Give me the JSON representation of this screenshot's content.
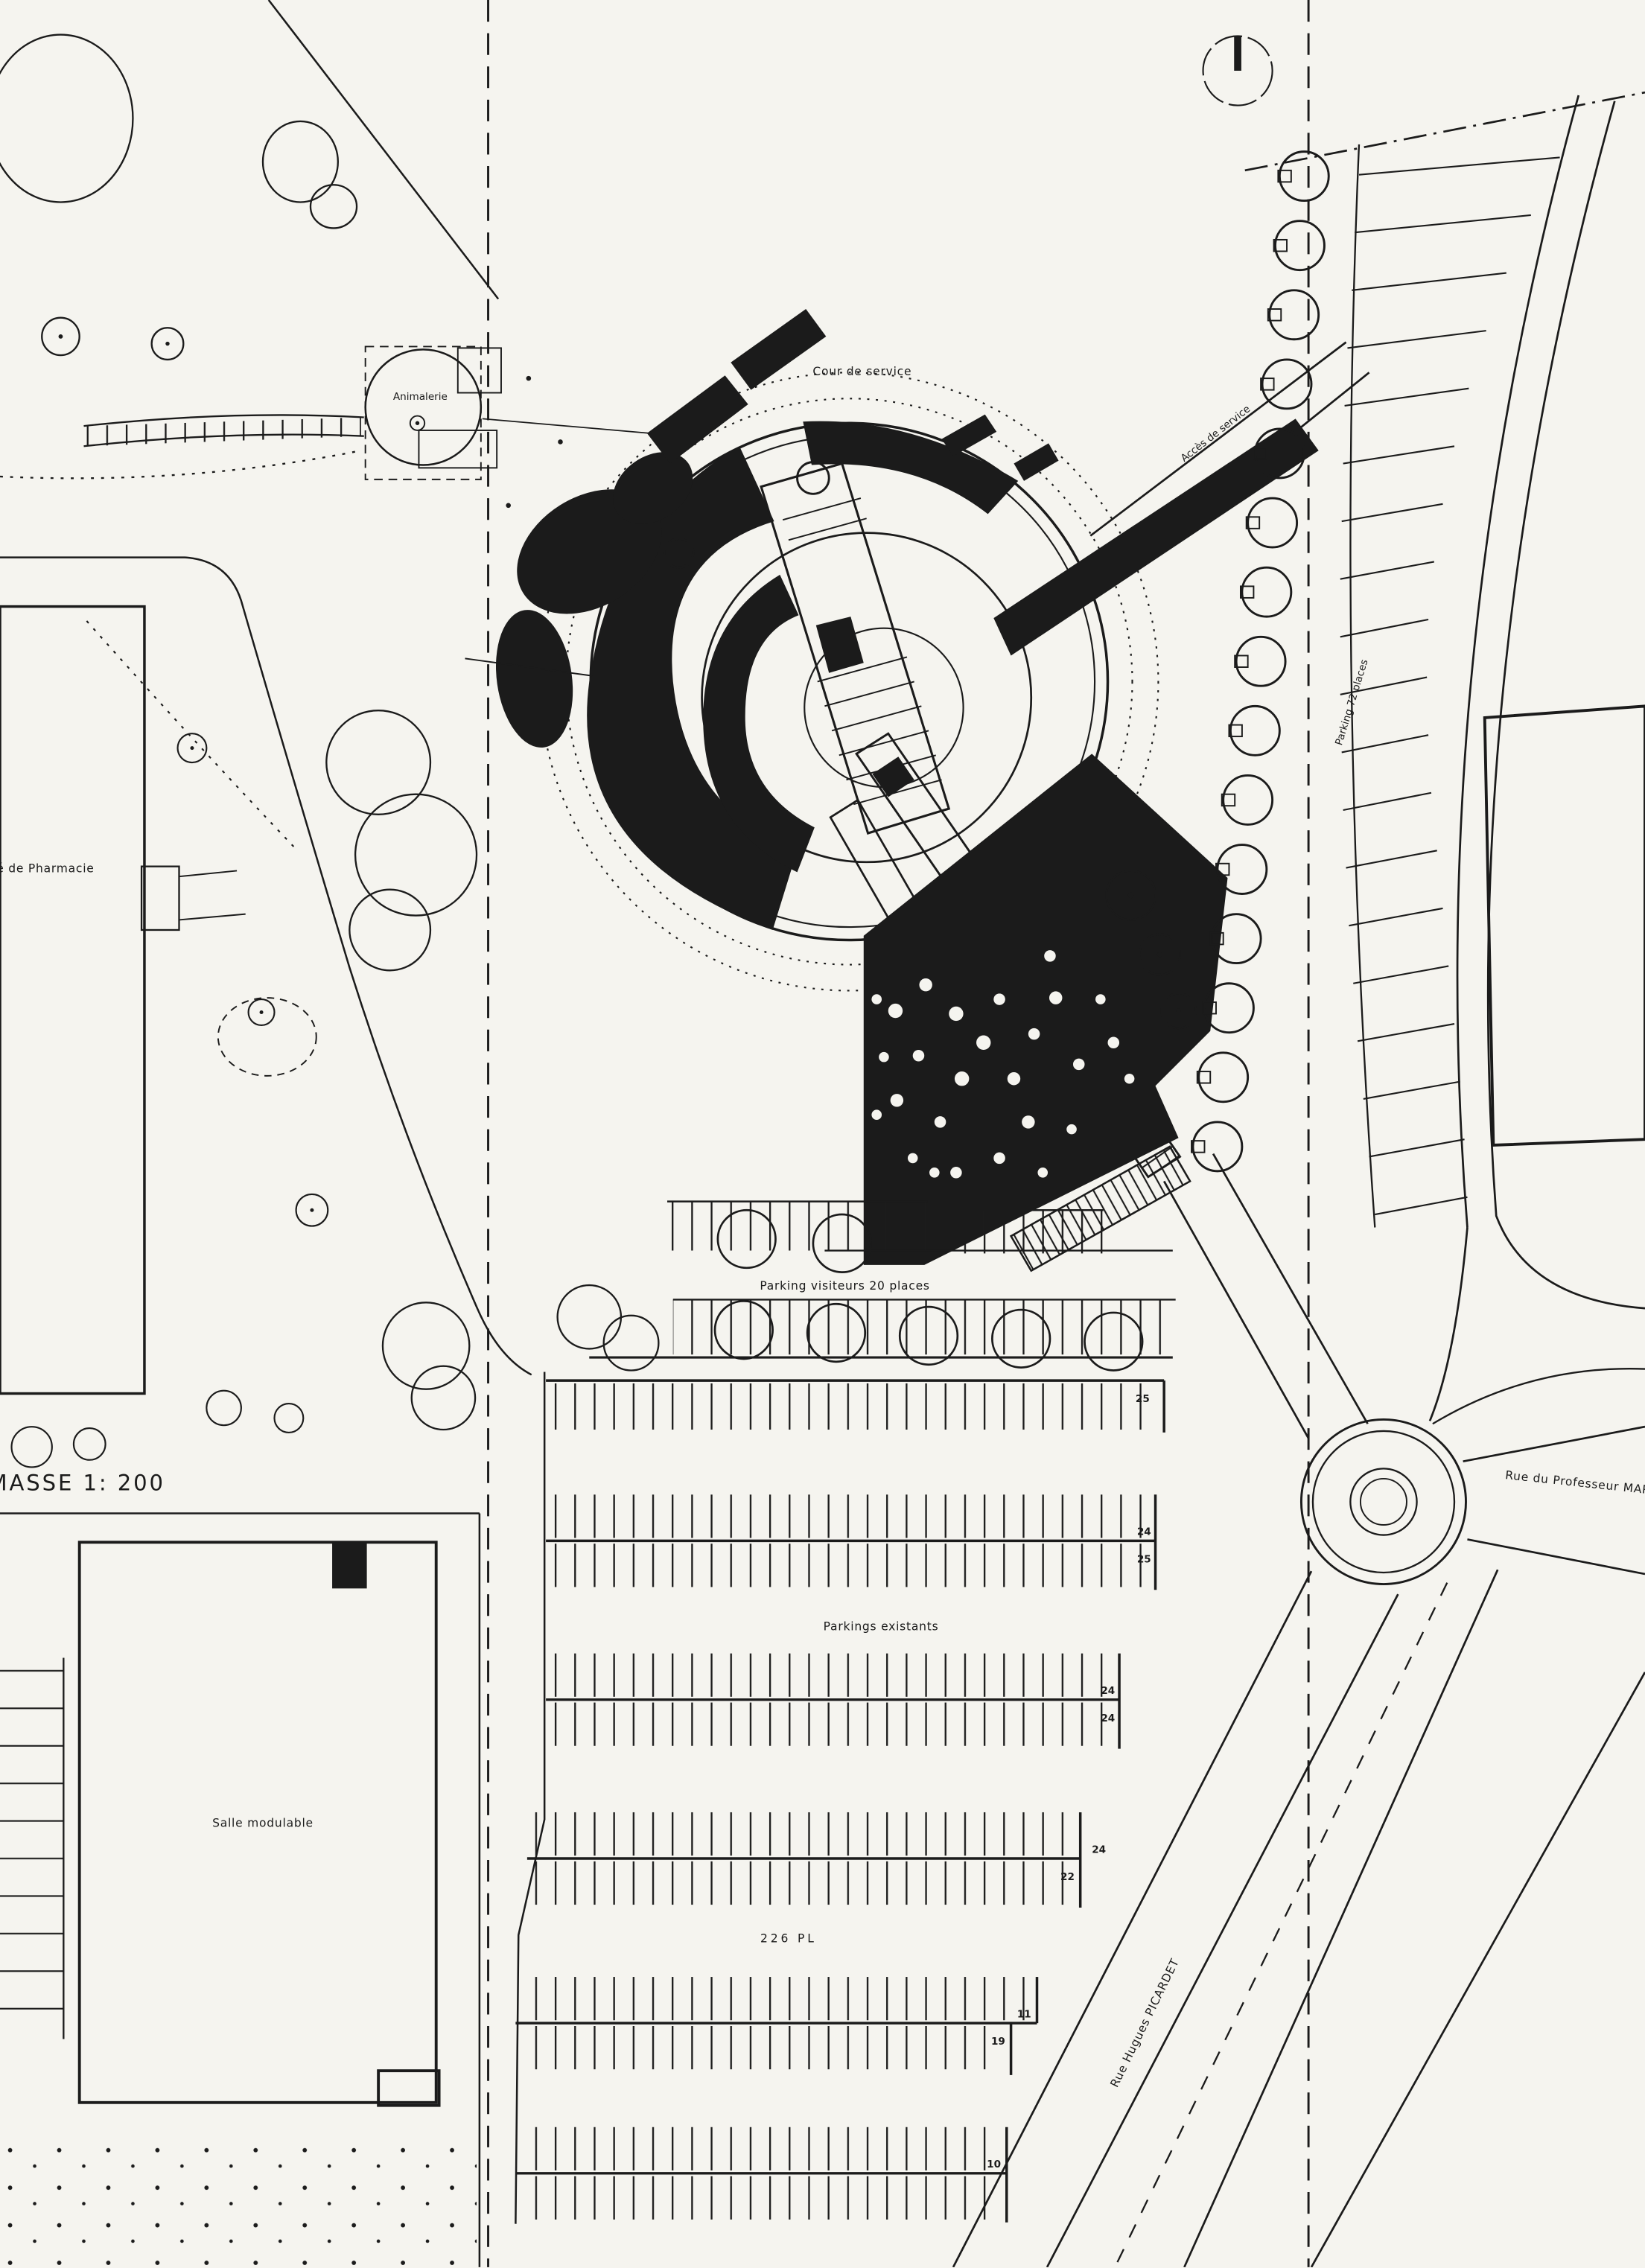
{
  "meta": {
    "drawing_type": "architectural site plan"
  },
  "labels": {
    "scale": "MASSE  1: 200",
    "animalerie": "Animalerie",
    "cour_de_service": "Cour de service",
    "acces_de_service": "Accès de service",
    "parking_72": "Parking 72 places",
    "pharmacie": "té de Pharmacie",
    "parking_visiteurs": "Parking visiteurs 20 places",
    "parkings_existants": "Parkings existants",
    "salle_modulable": "Salle modulable",
    "rue_professeur": "Rue du Professeur MARI",
    "rue_picardet": "Rue Hugues PICARDET",
    "total_places": "226 PL"
  },
  "parking_row_counts": {
    "row1_south": "25",
    "row2_north": "24",
    "row2_south": "25",
    "row3_north": "24",
    "row3_south": "24",
    "row4_north": "24",
    "row4_south": "22",
    "row5_north": "11",
    "row5_south": "19",
    "row6_north": "10"
  },
  "colors": {
    "paper": "#f5f4ef",
    "ink": "#1b1b1b"
  }
}
